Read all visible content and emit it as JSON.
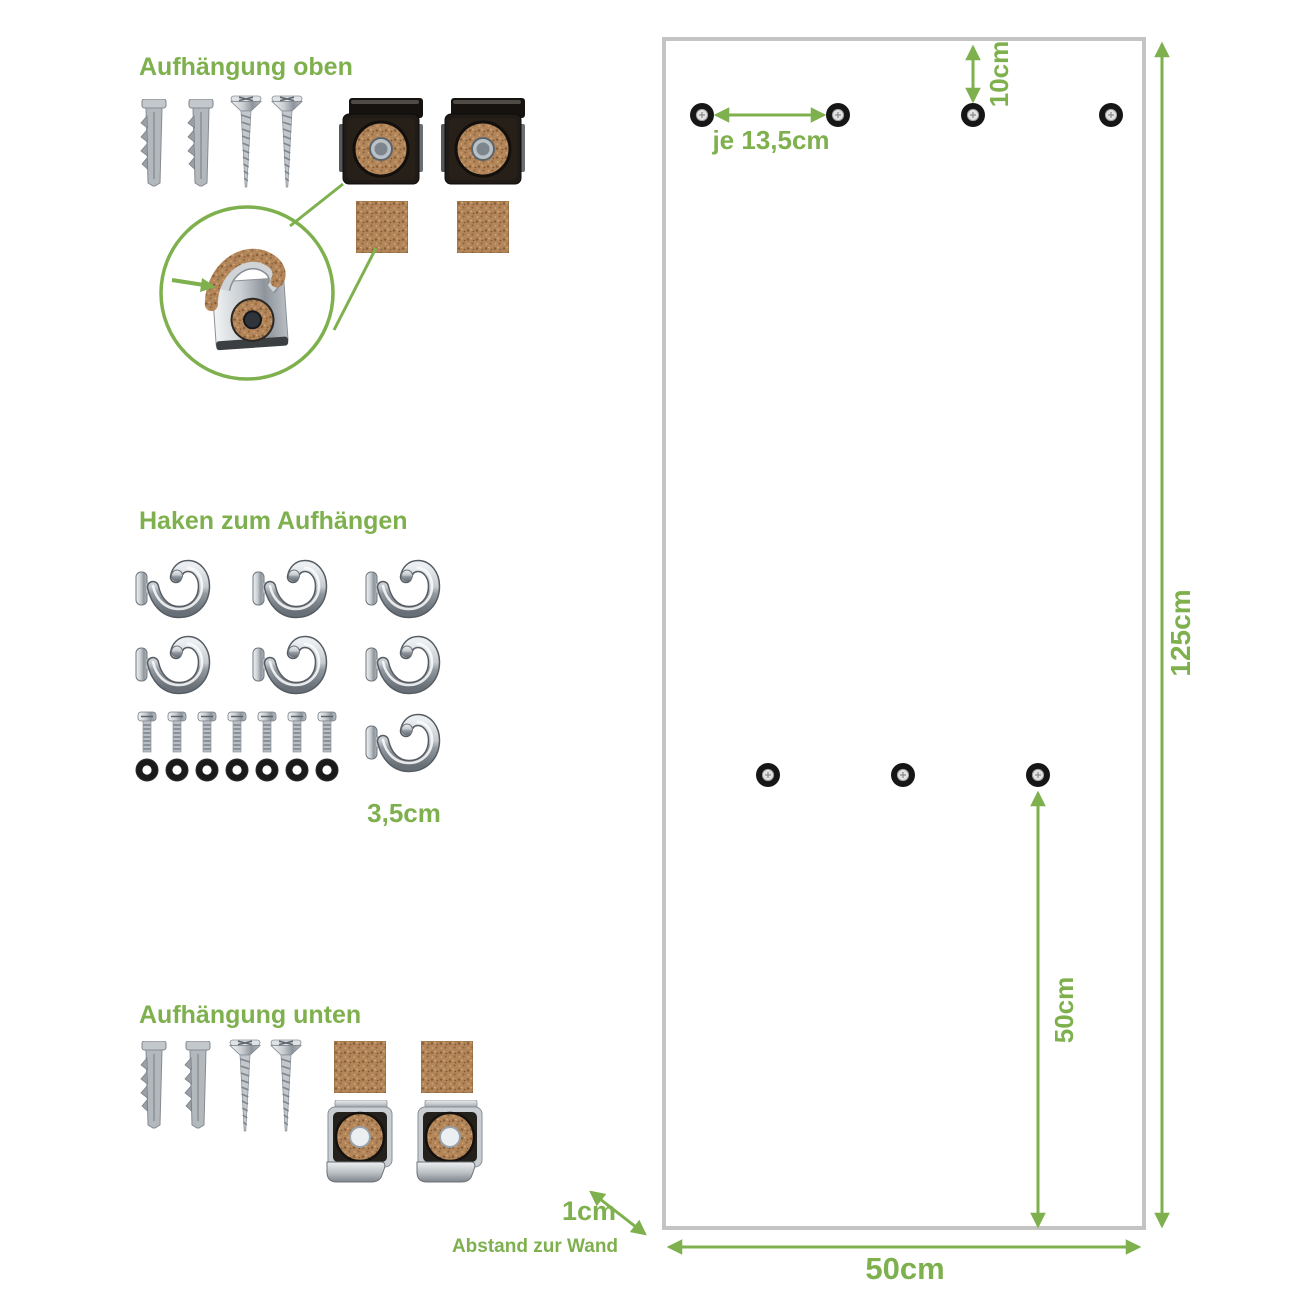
{
  "accent_color": "#7eb04e",
  "sections": {
    "top": {
      "title": "Aufhängung oben",
      "items": {
        "wall_plugs": 2,
        "screws": 2,
        "mounting_clips": 2,
        "cork_pads": 2
      },
      "detail": "clip-with-cork-magnified"
    },
    "hooks": {
      "title": "Haken zum Aufhängen",
      "measurement": "3,5cm",
      "items": {
        "hooks": 7,
        "bolts": 7,
        "washers": 7
      }
    },
    "bottom": {
      "title": "Aufhängung unten",
      "items": {
        "wall_plugs": 2,
        "screws": 2,
        "cork_pads": 2,
        "mounting_clips": 2
      }
    }
  },
  "panel": {
    "labels": {
      "top_spacing": "je 13,5cm",
      "top_offset": "10cm",
      "height": "125cm",
      "mid_height": "50cm",
      "width": "50cm",
      "wall_gap": "1cm",
      "wall_gap_caption": "Abstand zur Wand"
    },
    "holes": {
      "top_row": 4,
      "middle_row": 3
    }
  },
  "icons": [
    "wall-plug-icon",
    "screw-icon",
    "mounting-clip-top-icon",
    "cork-pad-icon",
    "clip-detail-magnifier-icon",
    "hook-icon",
    "bolt-icon",
    "washer-icon",
    "mounting-clip-bottom-icon"
  ]
}
